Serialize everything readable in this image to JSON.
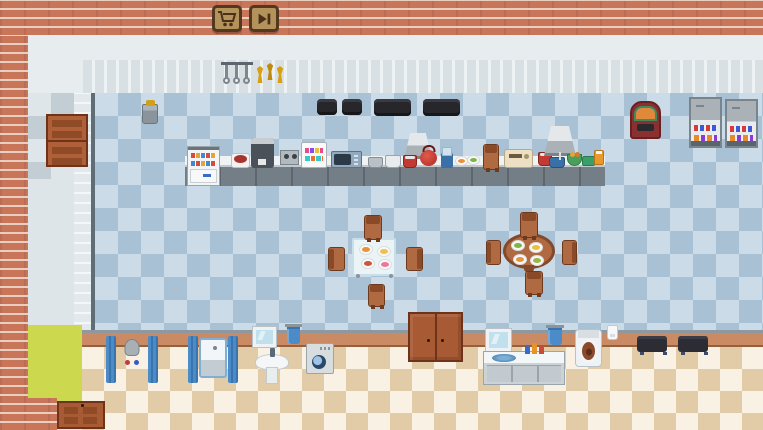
{
  "toolbar": {
    "buttons": [
      {
        "name": "shop-button",
        "icon": "cart-icon"
      },
      {
        "name": "fast-forward-button",
        "icon": "fast-forward-icon"
      }
    ]
  },
  "palette": {
    "brick": "#c8755a",
    "kitchen_floor_light": "#cbdce8",
    "kitchen_floor_dark": "#a9c1d4",
    "bathroom_floor_light": "#f8f1e4",
    "bathroom_floor_dark": "#e2cba7",
    "button_face": "#b3925c",
    "button_border": "#53381e",
    "door_wood": "#b06038",
    "divider_wall": "#c98a64",
    "rug_pad": "#ccd84e",
    "curtain_blue": "#4a8bc8",
    "gold": "#d6a012"
  },
  "entities": [
    {
      "name": "utensil-rack",
      "type": "rack",
      "x": 221,
      "y": 62,
      "w": 32,
      "h": 24,
      "interactable": false,
      "parts": [
        {
          "cls": "u u1",
          "name": "ladle"
        },
        {
          "cls": "u u2",
          "name": "ladle"
        },
        {
          "cls": "u u3",
          "name": "ladle"
        },
        {
          "cls": "uc uc1",
          "name": "ladle-head"
        },
        {
          "cls": "uc uc2",
          "name": "ladle-head"
        },
        {
          "cls": "uc uc3",
          "name": "ladle-head"
        }
      ]
    },
    {
      "name": "trophy-shelf",
      "type": "trophies",
      "x": 256,
      "y": 63,
      "w": 28,
      "h": 21,
      "interactable": false,
      "parts": [
        {
          "cls": "tr tr1",
          "name": "trophy"
        },
        {
          "cls": "tr tr2",
          "name": "trophy"
        },
        {
          "cls": "tr tr3",
          "name": "trophy"
        }
      ]
    },
    {
      "name": "trash-bin",
      "type": "bin",
      "x": 142,
      "y": 104,
      "w": 16,
      "h": 20,
      "interactable": true
    },
    {
      "name": "armchair-1",
      "type": "sofa-small",
      "x": 317,
      "y": 99,
      "w": 20,
      "h": 16,
      "interactable": true
    },
    {
      "name": "armchair-2",
      "type": "sofa-small",
      "x": 342,
      "y": 99,
      "w": 20,
      "h": 16,
      "interactable": true
    },
    {
      "name": "sofa-1",
      "type": "sofa-long",
      "x": 374,
      "y": 99,
      "w": 37,
      "h": 17,
      "interactable": true
    },
    {
      "name": "sofa-2",
      "type": "sofa-long",
      "x": 423,
      "y": 99,
      "w": 37,
      "h": 17,
      "interactable": true
    },
    {
      "name": "jukebox",
      "type": "jukebox",
      "x": 630,
      "y": 101,
      "w": 31,
      "h": 38,
      "interactable": true
    },
    {
      "name": "vending-machine-1",
      "type": "vending",
      "x": 689,
      "y": 97,
      "w": 33,
      "h": 51,
      "interactable": true,
      "parts": [
        {
          "cls": "vrow1",
          "name": "product-row"
        },
        {
          "cls": "vrow2",
          "name": "product-row"
        }
      ]
    },
    {
      "name": "vending-machine-2",
      "type": "vending",
      "x": 725,
      "y": 99,
      "w": 33,
      "h": 49,
      "interactable": true,
      "parts": [
        {
          "cls": "vrow1",
          "name": "product-row"
        },
        {
          "cls": "vrow2",
          "name": "product-row"
        }
      ]
    },
    {
      "name": "kitchen-counter",
      "type": "counter",
      "x": 185,
      "y": 156,
      "w": 420,
      "h": 30,
      "interactable": true
    },
    {
      "name": "display-fridge",
      "type": "fridge",
      "x": 187,
      "y": 146,
      "w": 33,
      "h": 40,
      "interactable": true,
      "parts": [
        {
          "cls": "frow1",
          "name": "shelf-items"
        },
        {
          "cls": "frow2",
          "name": "shelf-items"
        }
      ]
    },
    {
      "name": "rice-cooker",
      "type": "cooker",
      "x": 231,
      "y": 153,
      "w": 19,
      "h": 15,
      "interactable": true
    },
    {
      "name": "coffee-machine",
      "type": "coffee",
      "x": 251,
      "y": 138,
      "w": 23,
      "h": 30,
      "interactable": true
    },
    {
      "name": "countertop-stove",
      "type": "stove-s",
      "x": 280,
      "y": 150,
      "w": 19,
      "h": 15,
      "interactable": true
    },
    {
      "name": "dessert-display",
      "type": "candy",
      "x": 301,
      "y": 142,
      "w": 26,
      "h": 26,
      "interactable": true,
      "parts": [
        {
          "cls": "crow1",
          "name": "shelf-items"
        },
        {
          "cls": "crow2",
          "name": "shelf-items"
        }
      ]
    },
    {
      "name": "microwave",
      "type": "microwave",
      "x": 331,
      "y": 151,
      "w": 31,
      "h": 17,
      "interactable": true
    },
    {
      "name": "pot-1",
      "type": "pot-g",
      "x": 368,
      "y": 157,
      "w": 15,
      "h": 11,
      "interactable": true
    },
    {
      "name": "pot-2",
      "type": "pot-w",
      "x": 385,
      "y": 155,
      "w": 16,
      "h": 13,
      "interactable": true
    },
    {
      "name": "range-hood-1",
      "type": "hood",
      "x": 404,
      "y": 133,
      "w": 28,
      "h": 26,
      "interactable": false
    },
    {
      "name": "pot-red-1",
      "type": "pot-red",
      "x": 403,
      "y": 155,
      "w": 14,
      "h": 13,
      "interactable": true
    },
    {
      "name": "red-kettle",
      "type": "kettle",
      "x": 420,
      "y": 150,
      "w": 17,
      "h": 16,
      "interactable": true
    },
    {
      "name": "blender",
      "type": "blender",
      "x": 441,
      "y": 153,
      "w": 12,
      "h": 15,
      "interactable": true
    },
    {
      "name": "serving-plates",
      "type": "plates",
      "x": 456,
      "y": 155,
      "w": 26,
      "h": 13,
      "interactable": false,
      "parts": [
        {
          "cls": "pl pl1",
          "name": "plate",
          "color": "#e8923a"
        },
        {
          "cls": "pl pl2",
          "name": "plate",
          "color": "#7ab648"
        }
      ]
    },
    {
      "name": "counter-chair",
      "type": "chair n",
      "x": 483,
      "y": 144,
      "w": 16,
      "h": 26,
      "interactable": true
    },
    {
      "name": "bread-maker",
      "type": "toaster",
      "x": 504,
      "y": 149,
      "w": 29,
      "h": 19,
      "interactable": true
    },
    {
      "name": "pot-red-2",
      "type": "pot-red",
      "x": 538,
      "y": 152,
      "w": 14,
      "h": 14,
      "interactable": true
    },
    {
      "name": "range-hood-2",
      "type": "hood",
      "x": 544,
      "y": 126,
      "w": 32,
      "h": 30,
      "interactable": false
    },
    {
      "name": "pot-blue",
      "type": "potb",
      "x": 549,
      "y": 157,
      "w": 16,
      "h": 11,
      "interactable": true
    },
    {
      "name": "salad-bowl",
      "type": "bowl-g",
      "x": 567,
      "y": 154,
      "w": 15,
      "h": 12,
      "interactable": true
    },
    {
      "name": "green-box",
      "type": "box-g",
      "x": 582,
      "y": 156,
      "w": 13,
      "h": 10,
      "interactable": true
    },
    {
      "name": "orange-jar",
      "type": "jar-o",
      "x": 594,
      "y": 150,
      "w": 10,
      "h": 15,
      "interactable": true
    },
    {
      "name": "dining-table-square",
      "type": "table-sq",
      "x": 352,
      "y": 238,
      "w": 44,
      "h": 38,
      "interactable": true,
      "parts": [
        {
          "cls": "tp tp1",
          "name": "plate-food",
          "color": "#e8923a"
        },
        {
          "cls": "tp tp2",
          "name": "plate-food",
          "color": "#f0c04a"
        },
        {
          "cls": "tp tp3",
          "name": "plate-food",
          "color": "#c8583a"
        },
        {
          "cls": "tp tp4",
          "name": "plate-food",
          "color": "#e87a9a"
        }
      ]
    },
    {
      "name": "chair-1",
      "type": "chair n",
      "x": 364,
      "y": 215,
      "w": 18,
      "h": 25,
      "interactable": true
    },
    {
      "name": "chair-2",
      "type": "chair w",
      "x": 328,
      "y": 247,
      "w": 17,
      "h": 24,
      "interactable": true
    },
    {
      "name": "chair-3",
      "type": "chair e",
      "x": 406,
      "y": 247,
      "w": 17,
      "h": 24,
      "interactable": true
    },
    {
      "name": "chair-4",
      "type": "chair n",
      "x": 368,
      "y": 284,
      "w": 17,
      "h": 23,
      "interactable": true
    },
    {
      "name": "dining-table-round",
      "type": "table-rd",
      "x": 503,
      "y": 233,
      "w": 52,
      "h": 36,
      "interactable": true,
      "parts": [
        {
          "cls": "tp tp1",
          "name": "plate-food",
          "color": "#7ab648"
        },
        {
          "cls": "tp tp2",
          "name": "plate-food",
          "color": "#e8c23a"
        },
        {
          "cls": "tp tp3",
          "name": "plate-food",
          "color": "#e8923a"
        },
        {
          "cls": "tp tp4",
          "name": "plate-food",
          "color": "#9ab648"
        }
      ]
    },
    {
      "name": "chair-5",
      "type": "chair n",
      "x": 520,
      "y": 212,
      "w": 18,
      "h": 26,
      "interactable": true
    },
    {
      "name": "chair-6",
      "type": "chair w",
      "x": 486,
      "y": 240,
      "w": 15,
      "h": 25,
      "interactable": true
    },
    {
      "name": "chair-7",
      "type": "chair e",
      "x": 562,
      "y": 240,
      "w": 15,
      "h": 25,
      "interactable": true
    },
    {
      "name": "chair-8",
      "type": "chair n",
      "x": 525,
      "y": 271,
      "w": 18,
      "h": 24,
      "interactable": true
    },
    {
      "name": "kitchen-side-door",
      "type": "door-v",
      "x": 46,
      "y": 114,
      "w": 42,
      "h": 53,
      "interactable": true
    },
    {
      "name": "hall-double-door",
      "type": "door-h",
      "x": 408,
      "y": 312,
      "w": 55,
      "h": 50,
      "interactable": true
    },
    {
      "name": "storage-door",
      "type": "door-b",
      "x": 57,
      "y": 401,
      "w": 48,
      "h": 28,
      "interactable": true
    },
    {
      "name": "shower",
      "type": "shower",
      "x": 106,
      "y": 336,
      "w": 52,
      "h": 47,
      "interactable": true,
      "parts": [
        {
          "cls": "curtL",
          "name": "shower-curtain"
        },
        {
          "cls": "curtR",
          "name": "shower-curtain"
        }
      ]
    },
    {
      "name": "bathtub",
      "type": "tub",
      "x": 188,
      "y": 336,
      "w": 50,
      "h": 47,
      "interactable": true,
      "parts": [
        {
          "cls": "curtL",
          "name": "bath-curtain"
        },
        {
          "cls": "curtR",
          "name": "bath-curtain"
        }
      ]
    },
    {
      "name": "mirror-1",
      "type": "mirror",
      "x": 253,
      "y": 327,
      "w": 23,
      "h": 20,
      "interactable": false
    },
    {
      "name": "towel-1",
      "type": "towel",
      "x": 287,
      "y": 326,
      "w": 13,
      "h": 18,
      "interactable": false
    },
    {
      "name": "pedestal-sink",
      "type": "sinkped",
      "x": 255,
      "y": 348,
      "w": 34,
      "h": 36,
      "interactable": true,
      "parts": [
        {
          "cls": "faucet",
          "name": "faucet"
        }
      ]
    },
    {
      "name": "washing-machine",
      "type": "washer",
      "x": 306,
      "y": 343,
      "w": 28,
      "h": 31,
      "interactable": true
    },
    {
      "name": "bathroom-mirror",
      "type": "mirror",
      "x": 486,
      "y": 329,
      "w": 25,
      "h": 22,
      "interactable": false
    },
    {
      "name": "bathroom-vanity",
      "type": "vanity",
      "x": 483,
      "y": 351,
      "w": 82,
      "h": 34,
      "interactable": true,
      "parts": [
        {
          "cls": "vsink",
          "name": "vanity-sink"
        },
        {
          "cls": "vb b1",
          "name": "bottle"
        },
        {
          "cls": "vb b2",
          "name": "bottle"
        },
        {
          "cls": "vb b3",
          "name": "bottle"
        }
      ]
    },
    {
      "name": "towel-2",
      "type": "towel",
      "x": 548,
      "y": 327,
      "w": 14,
      "h": 18,
      "interactable": false
    },
    {
      "name": "toilet",
      "type": "toilet",
      "x": 575,
      "y": 329,
      "w": 27,
      "h": 38,
      "interactable": true,
      "parts": [
        {
          "cls": "seat",
          "name": "toilet-seat"
        }
      ]
    },
    {
      "name": "toilet-paper",
      "type": "paper",
      "x": 607,
      "y": 325,
      "w": 11,
      "h": 15,
      "interactable": false
    },
    {
      "name": "bench-1",
      "type": "bench",
      "x": 637,
      "y": 336,
      "w": 30,
      "h": 16,
      "interactable": true
    },
    {
      "name": "bench-2",
      "type": "bench",
      "x": 678,
      "y": 336,
      "w": 30,
      "h": 16,
      "interactable": true
    }
  ]
}
